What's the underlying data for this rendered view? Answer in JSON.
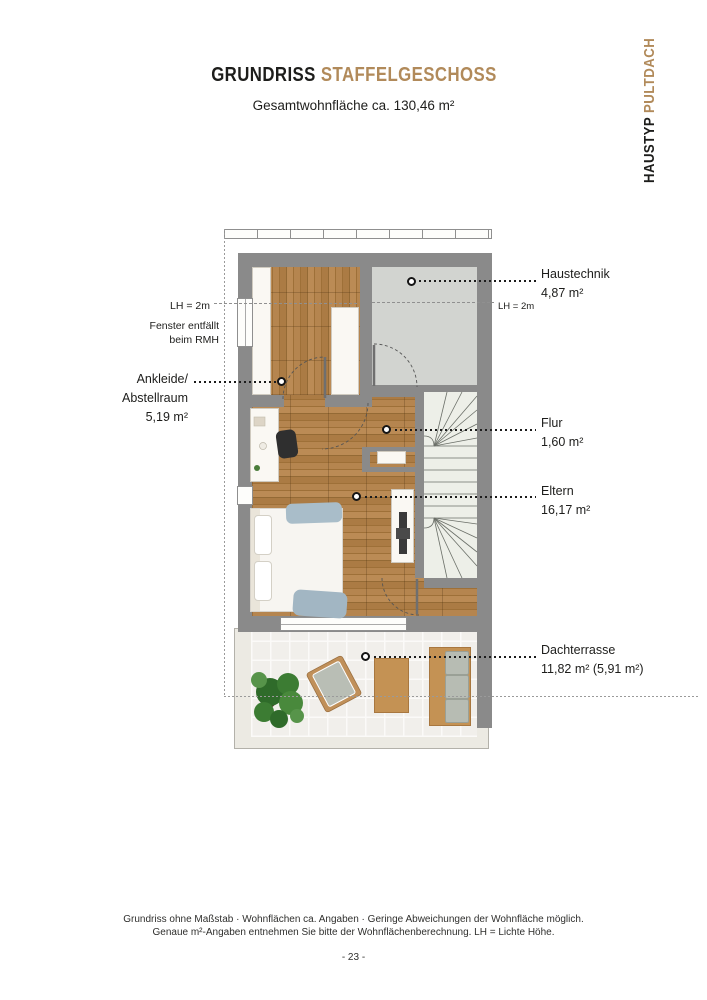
{
  "page": {
    "title": {
      "part1": "GRUNDRISS",
      "part2": "STAFFELGESCHOSS"
    },
    "subtitle": "Gesamtwohnfläche ca. 130,46 m²",
    "side_label": {
      "part1": "HAUSTYP",
      "part2": "PULTDACH"
    },
    "footer": {
      "line1": "Grundriss ohne Maßstab · Wohnflächen ca. Angaben · Geringe Abweichungen der Wohnfläche möglich.",
      "line2": "Genaue m²-Angaben entnehmen Sie bitte der Wohnflächenberechnung. LH = Lichte Höhe.",
      "page_number": "- 23 -"
    }
  },
  "plan": {
    "rooms": [
      {
        "id": "haustechnik",
        "label": "Haustechnik",
        "area": "4,87 m²"
      },
      {
        "id": "ankleide",
        "label": "Ankleide/",
        "label2": "Abstellraum",
        "area": "5,19 m²"
      },
      {
        "id": "flur",
        "label": "Flur",
        "area": "1,60 m²"
      },
      {
        "id": "eltern",
        "label": "Eltern",
        "area": "16,17 m²"
      },
      {
        "id": "dachterrasse",
        "label": "Dachterrasse",
        "area": "11,82 m² (5,91 m²)"
      }
    ],
    "annotations": {
      "lh_left": "LH = 2m",
      "lh_right": "LH = 2m",
      "fenster_line1": "Fenster entfällt",
      "fenster_line2": "beim RMH"
    }
  },
  "colors": {
    "accent_tan": "#b18a5a",
    "text_black": "#1d1d1b",
    "wall_gray": "#8a8a8a",
    "wood_floor": "#ad7d45",
    "tech_floor": "#d2d4d0",
    "stair_floor": "#edefe8",
    "terrace_tile": "#f1efeb"
  }
}
